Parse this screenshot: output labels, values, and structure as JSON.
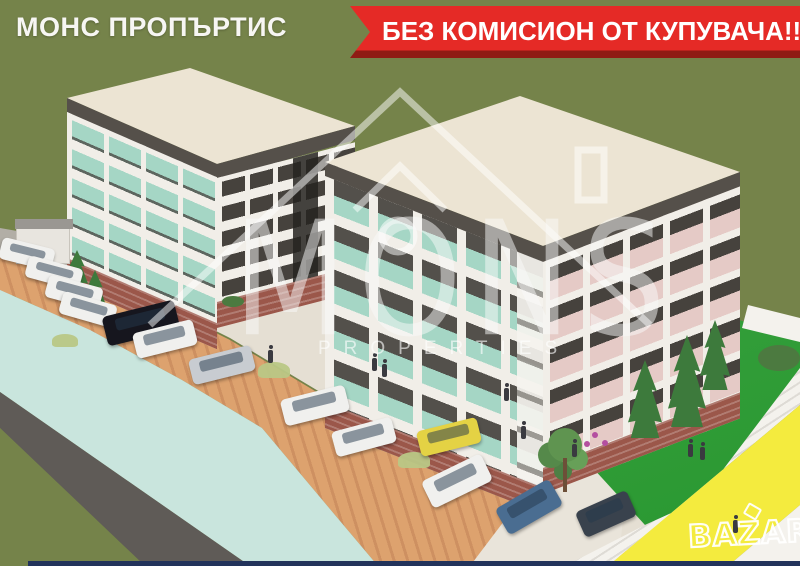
{
  "overlay": {
    "agency_name": "МОНС ПРОПЪРТИС",
    "banner_text": "БЕЗ КОМИСИОН ОТ КУПУВАЧА!!!",
    "logo_text": "MONS",
    "logo_subtext": "PROPERTIES",
    "marketplace_watermark": "BAZAR"
  },
  "palette": {
    "olive": "#75834a",
    "banner_red": "#e52a26",
    "banner_red_dark": "#8f1b14",
    "text_white": "#f7f6f3",
    "mint": "#c9e5dd",
    "road_gray": "#5f5b57",
    "parking_tan": "#dda26e",
    "walkway": "#e5dfd3",
    "apron_gray": "#b2aea6",
    "lawn_green": "#2da135",
    "yellow_stripe": "#f4eb3e",
    "corner_white": "#f4f2ed",
    "roof_cream": "#ece4d3",
    "roof_trim": "#55504a",
    "wall_white": "#f1eee8",
    "facade_dark": "#46423d",
    "balcony_teal": "#a5d6c5",
    "brick": "#9b574a",
    "pink_wall": "#e5cac6",
    "bottom_line": "#22335b",
    "watermark_white": "rgba(250,250,250,0.5)",
    "car_white": "#f0f0ee",
    "car_black": "#16161e",
    "car_silver": "#c8ccd1",
    "car_yellow": "#e4d244",
    "car_blue": "#4a6d91",
    "car_darkgray": "#39424d",
    "tree_green": "#3d7a3c",
    "tree_light": "#5f9450"
  },
  "scene": {
    "car_colors": [
      "white",
      "white",
      "white",
      "white",
      "black",
      "white",
      "silver",
      "white",
      "white",
      "yellow",
      "white",
      "blue",
      "dark-gray"
    ]
  }
}
